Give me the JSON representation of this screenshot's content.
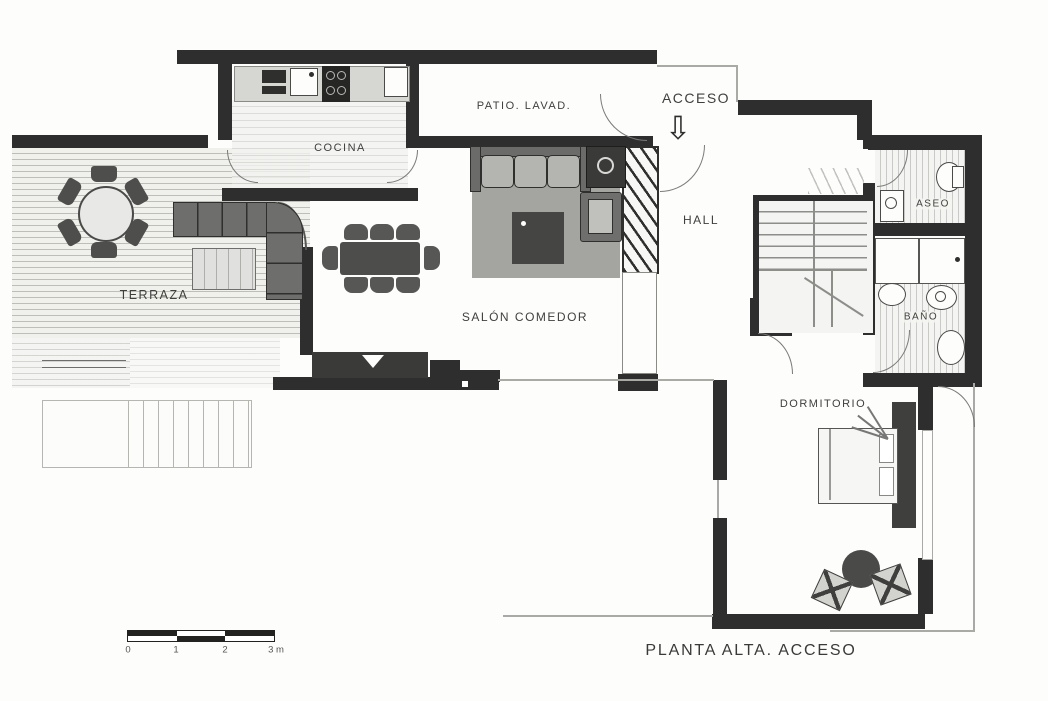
{
  "title": "PLANTA ALTA. ACCESO",
  "rooms": {
    "terraza": "TERRAZA",
    "cocina": "COCINA",
    "patio_lavadero": "PATIO. LAVAD.",
    "acceso": "ACCESO",
    "hall": "HALL",
    "aseo": "ASEO",
    "bano": "BAÑO",
    "salon_comedor": "SALÓN COMEDOR",
    "dormitorio": "DORMITORIO"
  },
  "acceso_arrow_glyph": "⇩",
  "scale_bar": {
    "tick_labels": [
      "0",
      "1",
      "2",
      "3 m"
    ]
  },
  "colors": {
    "wall": "#2e2e2e",
    "thin_line": "#a9a9a6",
    "furniture_dark": "#4a4a48",
    "furniture_mid": "#6e6e6c",
    "cushion": "#b4b4b1",
    "rug": "#a4a4a0",
    "deck_line": "#bdbdba",
    "label_text": "#3f3f3d"
  }
}
